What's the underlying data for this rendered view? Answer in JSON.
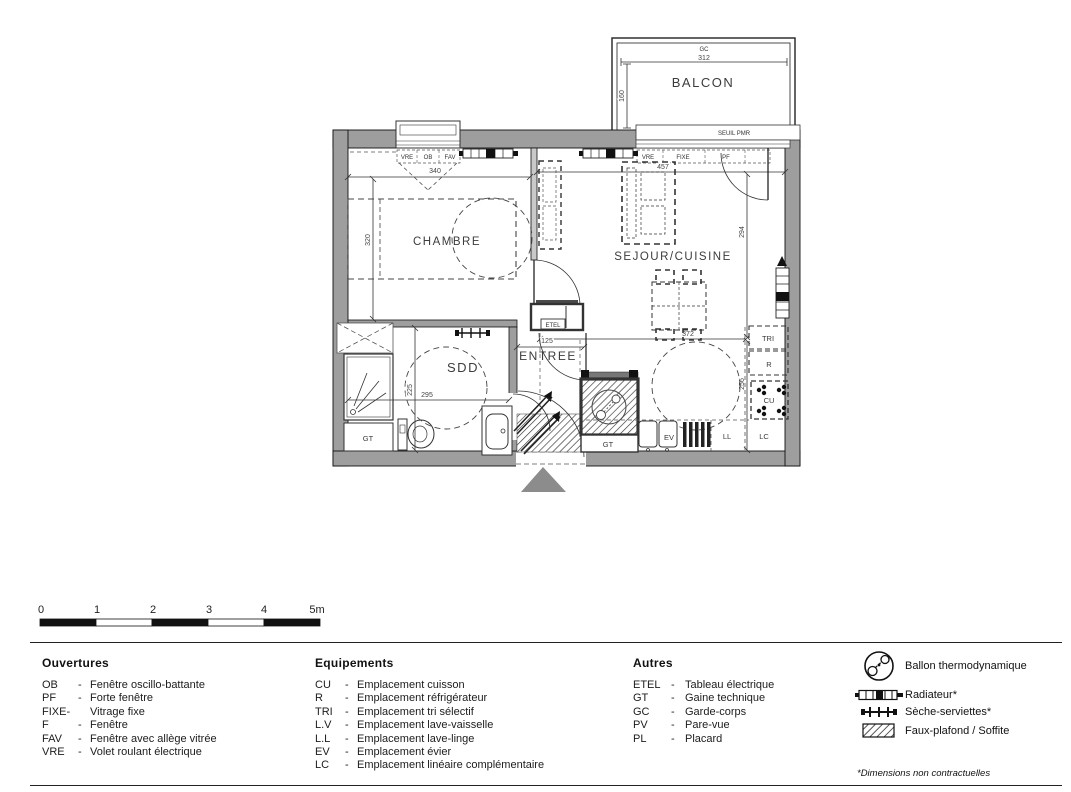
{
  "plan": {
    "balcony": {
      "label": "BALCON",
      "gc": "GC",
      "width": "312",
      "depth": "160",
      "seuil": "SEUIL PMR"
    },
    "bedroom": {
      "label": "CHAMBRE",
      "width": "340",
      "depth": "320",
      "window": {
        "vre": "VRE",
        "ob": "OB",
        "fav": "FAV"
      }
    },
    "living": {
      "label": "SEJOUR/CUISINE",
      "width": "457",
      "depth": "294",
      "inner_width": "372",
      "inner_depth": "256",
      "window": {
        "vre": "VRE",
        "fixe": "FIXE",
        "pf": "PF"
      }
    },
    "bathroom": {
      "label": "SDD",
      "width": "295",
      "depth": "225",
      "gt": "GT"
    },
    "entry": {
      "label": "ENTREE",
      "width": "125",
      "etel": "ETEL"
    },
    "kitchen": {
      "gt": "GT",
      "ev": "EV",
      "ll": "LL",
      "lc": "LC",
      "tri": "TRI",
      "r": "R",
      "cu": "CU"
    }
  },
  "scalebar": {
    "ticks": [
      "0",
      "1",
      "2",
      "3",
      "4",
      "5m"
    ]
  },
  "legend": {
    "sep": "-",
    "ouvertures": {
      "title": "Ouvertures",
      "items": [
        {
          "abbr": "OB",
          "desc": "Fenêtre oscillo-battante"
        },
        {
          "abbr": "PF",
          "desc": "Forte fenêtre"
        },
        {
          "abbr": "FIXE-",
          "desc": "Vitrage fixe"
        },
        {
          "abbr": "F",
          "desc": "Fenêtre"
        },
        {
          "abbr": "FAV",
          "desc": "Fenêtre avec allège vitrée"
        },
        {
          "abbr": "VRE",
          "desc": "Volet roulant électrique"
        }
      ]
    },
    "equipements": {
      "title": "Equipements",
      "items": [
        {
          "abbr": "CU",
          "desc": "Emplacement cuisson"
        },
        {
          "abbr": "R",
          "desc": "Emplacement réfrigérateur"
        },
        {
          "abbr": "TRI",
          "desc": "Emplacement tri sélectif"
        },
        {
          "abbr": "L.V",
          "desc": "Emplacement lave-vaisselle"
        },
        {
          "abbr": "L.L",
          "desc": "Emplacement lave-linge"
        },
        {
          "abbr": "EV",
          "desc": "Emplacement évier"
        },
        {
          "abbr": "LC",
          "desc": "Emplacement linéaire complémentaire"
        }
      ]
    },
    "autres": {
      "title": "Autres",
      "items": [
        {
          "abbr": "ETEL",
          "desc": "Tableau électrique"
        },
        {
          "abbr": "GT",
          "desc": "Gaine technique"
        },
        {
          "abbr": "GC",
          "desc": "Garde-corps"
        },
        {
          "abbr": "PV",
          "desc": "Pare-vue"
        },
        {
          "abbr": "PL",
          "desc": "Placard"
        }
      ]
    },
    "symbols": {
      "items": [
        {
          "name": "Ballon thermodynamique"
        },
        {
          "name": "Radiateur*"
        },
        {
          "name": "Sèche-serviettes*"
        },
        {
          "name": "Faux-plafond / Soffite"
        }
      ]
    },
    "note": "*Dimensions non contractuelles"
  },
  "colors": {
    "wall": "#9e9e9e",
    "line": "#1a1a1a",
    "text": "#3a3a3a",
    "triangle": "#8c8c8c"
  }
}
